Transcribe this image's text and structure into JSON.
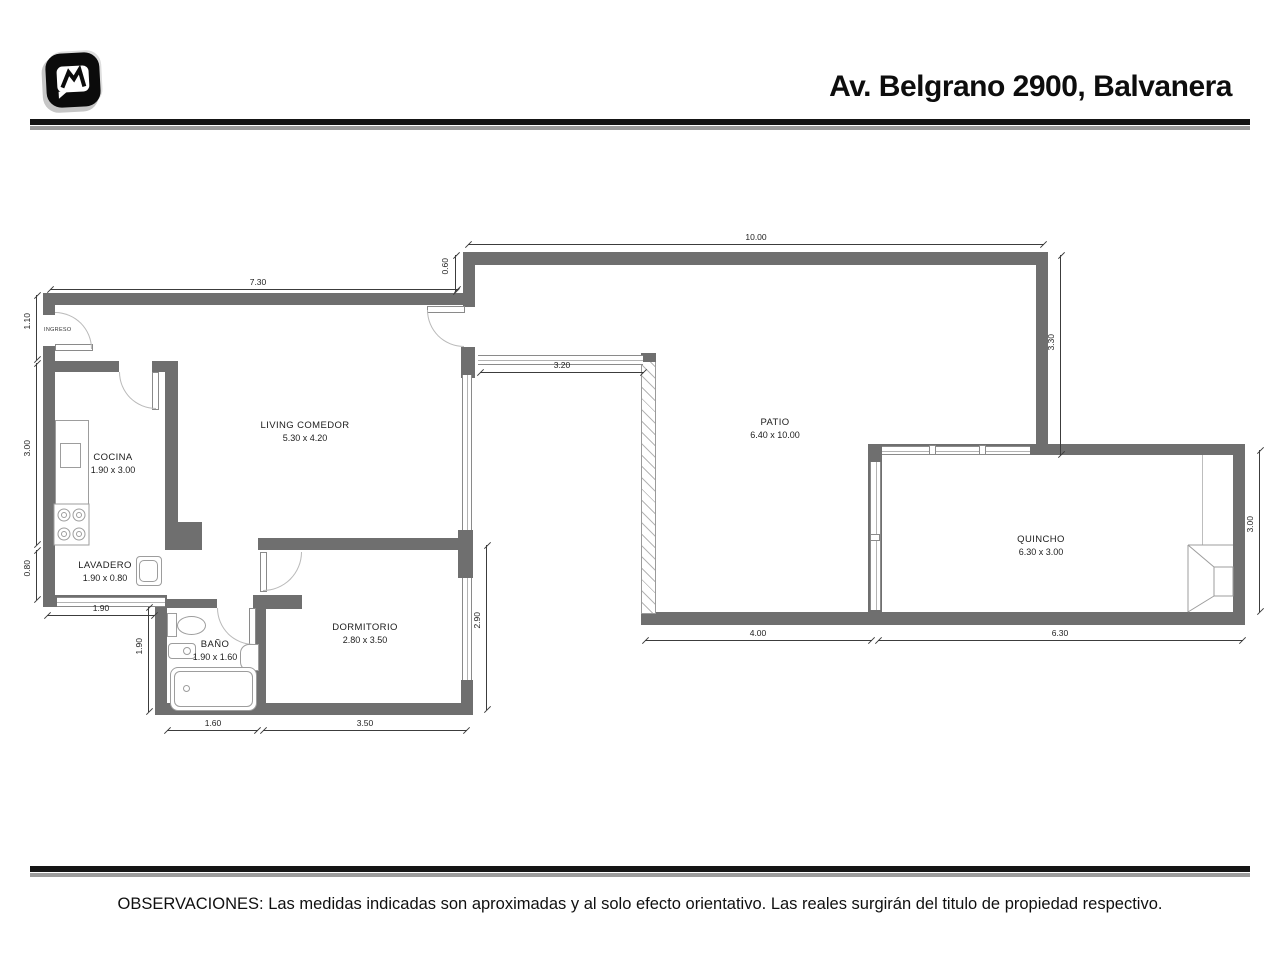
{
  "header": {
    "title": "Av. Belgrano 2900, Balvanera"
  },
  "footer": {
    "observations": "OBSERVACIONES: Las medidas indicadas son aproximadas y al solo efecto orientativo. Las reales surgirán del titulo de propiedad respectivo."
  },
  "plan": {
    "entry_label": "INGRESO",
    "rooms": {
      "living": {
        "name": "LIVING COMEDOR",
        "size": "5.30 x 4.20"
      },
      "cocina": {
        "name": "COCINA",
        "size": "1.90 x 3.00"
      },
      "lavadero": {
        "name": "LAVADERO",
        "size": "1.90 x 0.80"
      },
      "bano": {
        "name": "BAÑO",
        "size": "1.90 x 1.60"
      },
      "dormitorio": {
        "name": "DORMITORIO",
        "size": "2.80 x 3.50"
      },
      "patio": {
        "name": "PATIO",
        "size": "6.40 x 10.00"
      },
      "quincho": {
        "name": "QUINCHO",
        "size": "6.30 x 3.00"
      }
    },
    "dims": {
      "top": "10.00",
      "left_top": "7.30",
      "jog": "0.60",
      "patio_right": "3.30",
      "entry": "1.10",
      "cocina_h": "3.00",
      "lavadero_h": "0.80",
      "lavadero_w": "1.90",
      "bano_h": "1.90",
      "bano_w": "1.60",
      "dorm_w": "3.50",
      "dorm_win": "2.90",
      "living_win": "3.20",
      "patio_bottom": "4.00",
      "quincho_w": "6.30",
      "quincho_h": "3.00"
    },
    "colors": {
      "wall": "#6f6f6f",
      "dim": "#3c3c3c"
    }
  }
}
